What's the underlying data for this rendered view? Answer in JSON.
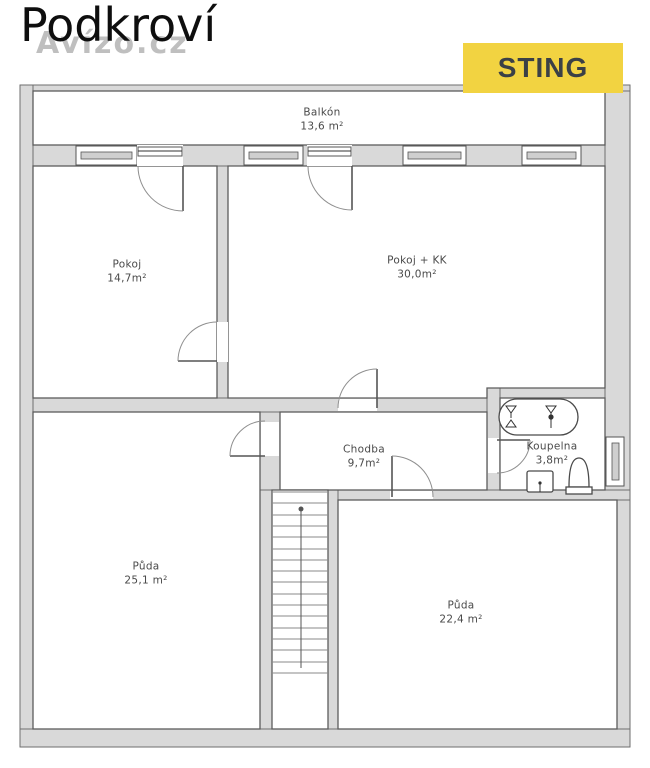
{
  "header": {
    "title": "Podkroví",
    "watermark": "Avízo.cz",
    "brand": "STING"
  },
  "colors": {
    "brand_bg": "#F2D341",
    "brand_text": "#3B4046",
    "wall_fill": "#D9D9D9",
    "wall_line": "#6E6E6E",
    "label_text": "#4A4A4A"
  },
  "rooms": {
    "balkon": {
      "name": "Balkón",
      "area": "13,6 m²"
    },
    "pokoj": {
      "name": "Pokoj",
      "area": "14,7m²"
    },
    "pokoj_kk": {
      "name": "Pokoj + KK",
      "area": "30,0m²"
    },
    "chodba": {
      "name": "Chodba",
      "area": "9,7m²"
    },
    "koupelna": {
      "name": "Koupelna",
      "area": "3,8m²"
    },
    "puda_left": {
      "name": "Půda",
      "area": "25,1 m²"
    },
    "puda_right": {
      "name": "Půda",
      "area": "22,4 m²"
    }
  },
  "fixtures": {
    "bathtub": "bathtub",
    "sink": "sink",
    "toilet": "toilet",
    "staircase": "staircase (16 steps, up)"
  }
}
